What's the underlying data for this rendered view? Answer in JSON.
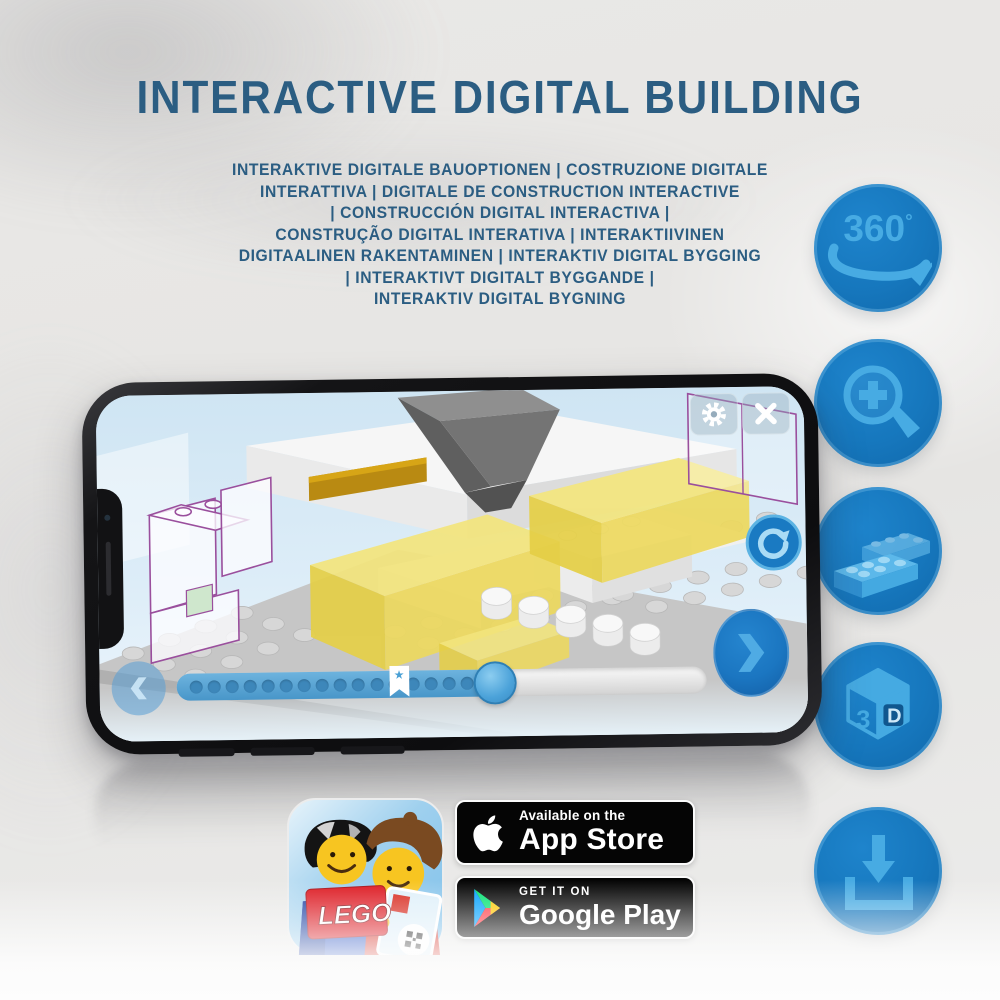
{
  "header": {
    "title": "INTERACTIVE DIGITAL BUILDING",
    "subtitle_lines": [
      "INTERAKTIVE DIGITALE BAUOPTIONEN | COSTRUZIONE DIGITALE",
      "INTERATTIVA | DIGITALE DE CONSTRUCTION INTERACTIVE",
      "| CONSTRUCCIÓN DIGITAL INTERACTIVA |",
      "CONSTRUÇÃO DIGITAL INTERATIVA | INTERAKTIIVINEN",
      "DIGITAALINEN RAKENTAMINEN | INTERAKTIV DIGITAL BYGGING",
      "| INTERAKTIVT DIGITALT BYGGANDE |",
      "INTERAKTIV DIGITAL BYGNING"
    ]
  },
  "feature_icons": {
    "rotation_360": {
      "label": "360",
      "degree": "o"
    },
    "cube_3d": {
      "left": "3",
      "right": "D"
    }
  },
  "phone": {
    "progress": {
      "dots_total": 16,
      "filled_percent": 60,
      "bookmark_percent": 42
    },
    "icons": {
      "star": "★"
    }
  },
  "store_badges": {
    "app_store": {
      "line1": "Available on the",
      "line2": "App Store"
    },
    "google_play": {
      "line1": "GET IT ON",
      "line2": "Google Play"
    }
  },
  "app_icon": {
    "logo_text": "LEGO"
  },
  "colors": {
    "headline_blue": "#2b5d82",
    "circle_blue": "#1677bd",
    "icon_light_blue": "#47abe3",
    "brick_yellow": "#e9d455",
    "badge_black": "#050505"
  }
}
